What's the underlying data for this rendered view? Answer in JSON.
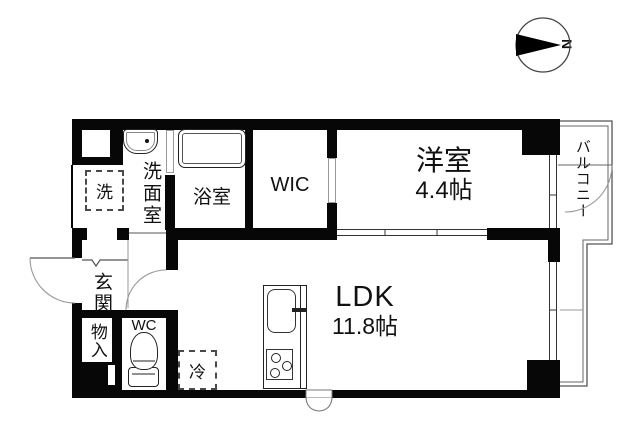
{
  "compass": {
    "north_label": "N"
  },
  "rooms": {
    "laundry": {
      "label": "洗面室"
    },
    "bath": {
      "label": "浴室"
    },
    "wic": {
      "label": "WIC"
    },
    "bedroom": {
      "label": "洋室",
      "size": "4.4帖"
    },
    "balcony": {
      "label": "バルコニー"
    },
    "ldk": {
      "label": "LDK",
      "size": "11.8帖"
    },
    "entrance": {
      "label": "玄関"
    },
    "storage": {
      "label": "物入"
    },
    "wc": {
      "label": "WC"
    }
  },
  "fixtures": {
    "washer_label": "洗",
    "fridge_label": "冷"
  },
  "colors": {
    "wall": "#070707",
    "background": "#ffffff",
    "thin_line": "#888888"
  }
}
